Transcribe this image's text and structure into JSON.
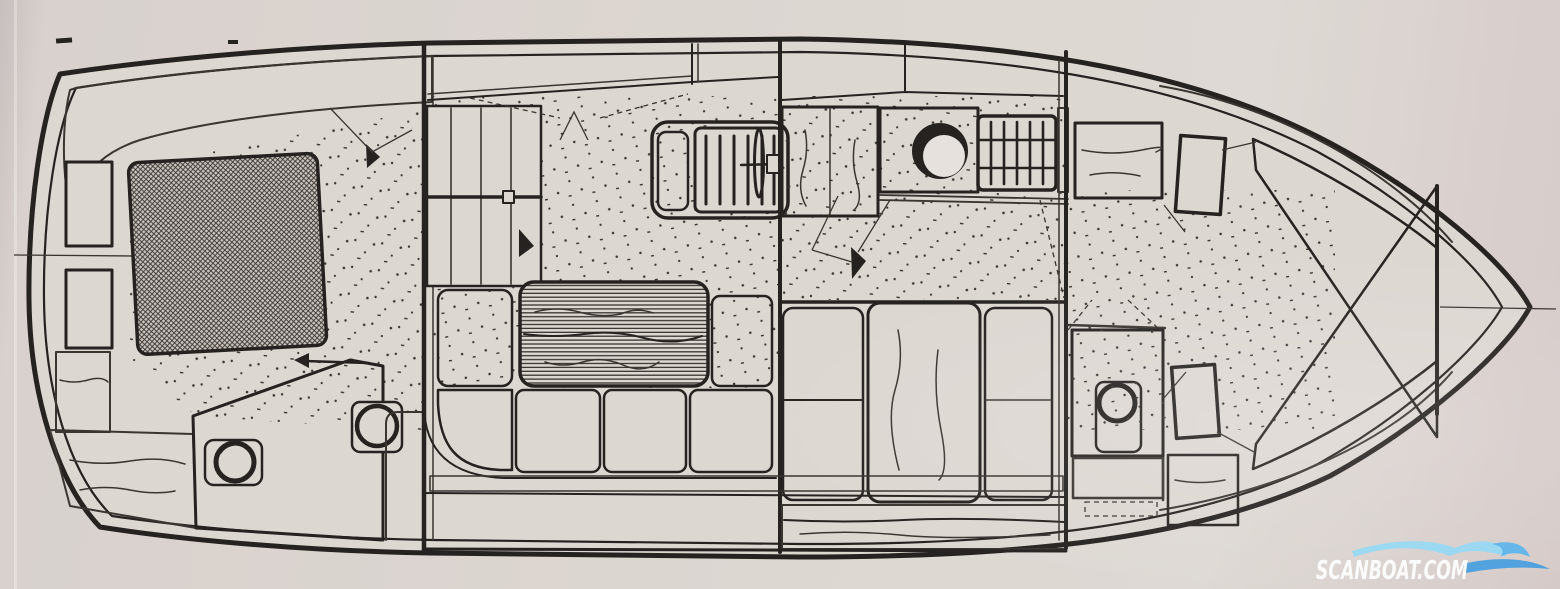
{
  "document": {
    "kind": "scanned boat interior layout plan, top view line drawing",
    "orientation": "stern at left, bow at right",
    "visible_text": [
      "SCANBOAT.COM"
    ]
  },
  "watermark": {
    "text": "SCANBOAT.COM"
  },
  "colors": {
    "paper": "#d8d1cd",
    "paper_int": "#ddd7d2",
    "paper_edge": "#c7bfbd",
    "paper_pink": "#d6cbc9",
    "ink": "#262220",
    "ink_soft": "#3a3531",
    "wm_text": "#ffffff",
    "wm_blue_light": "#8ed8f7",
    "wm_blue_mid": "#57b2ea",
    "wm_blue_deep": "#3f9bdf"
  },
  "regions": [
    {
      "name": "aft-cabin",
      "features": [
        "double-berth",
        "side-locker",
        "side-locker",
        "steps",
        "slatted-side-deck"
      ]
    },
    {
      "name": "aft-head",
      "features": [
        "toilet",
        "washbasin",
        "tiled-floor",
        "companionway-arrow"
      ]
    },
    {
      "name": "saloon",
      "features": [
        "u-settee",
        "table",
        "helm-console",
        "helm-seat",
        "steering-wheel"
      ]
    },
    {
      "name": "galley",
      "features": [
        "wardrobe",
        "sink",
        "stove",
        "worktop"
      ]
    },
    {
      "name": "mid-cabin",
      "features": [
        "berth",
        "wardrobe-door",
        "berth",
        "plank-floor"
      ]
    },
    {
      "name": "forward-head",
      "features": [
        "toilet",
        "tiled-floor",
        "slatted-shelf"
      ]
    },
    {
      "name": "forward-cabin",
      "features": [
        "v-berth-upper",
        "v-berth-lower",
        "shelf",
        "locker-door",
        "locker-door"
      ]
    },
    {
      "name": "bow",
      "features": [
        "anchor-locker",
        "centerline"
      ]
    }
  ]
}
